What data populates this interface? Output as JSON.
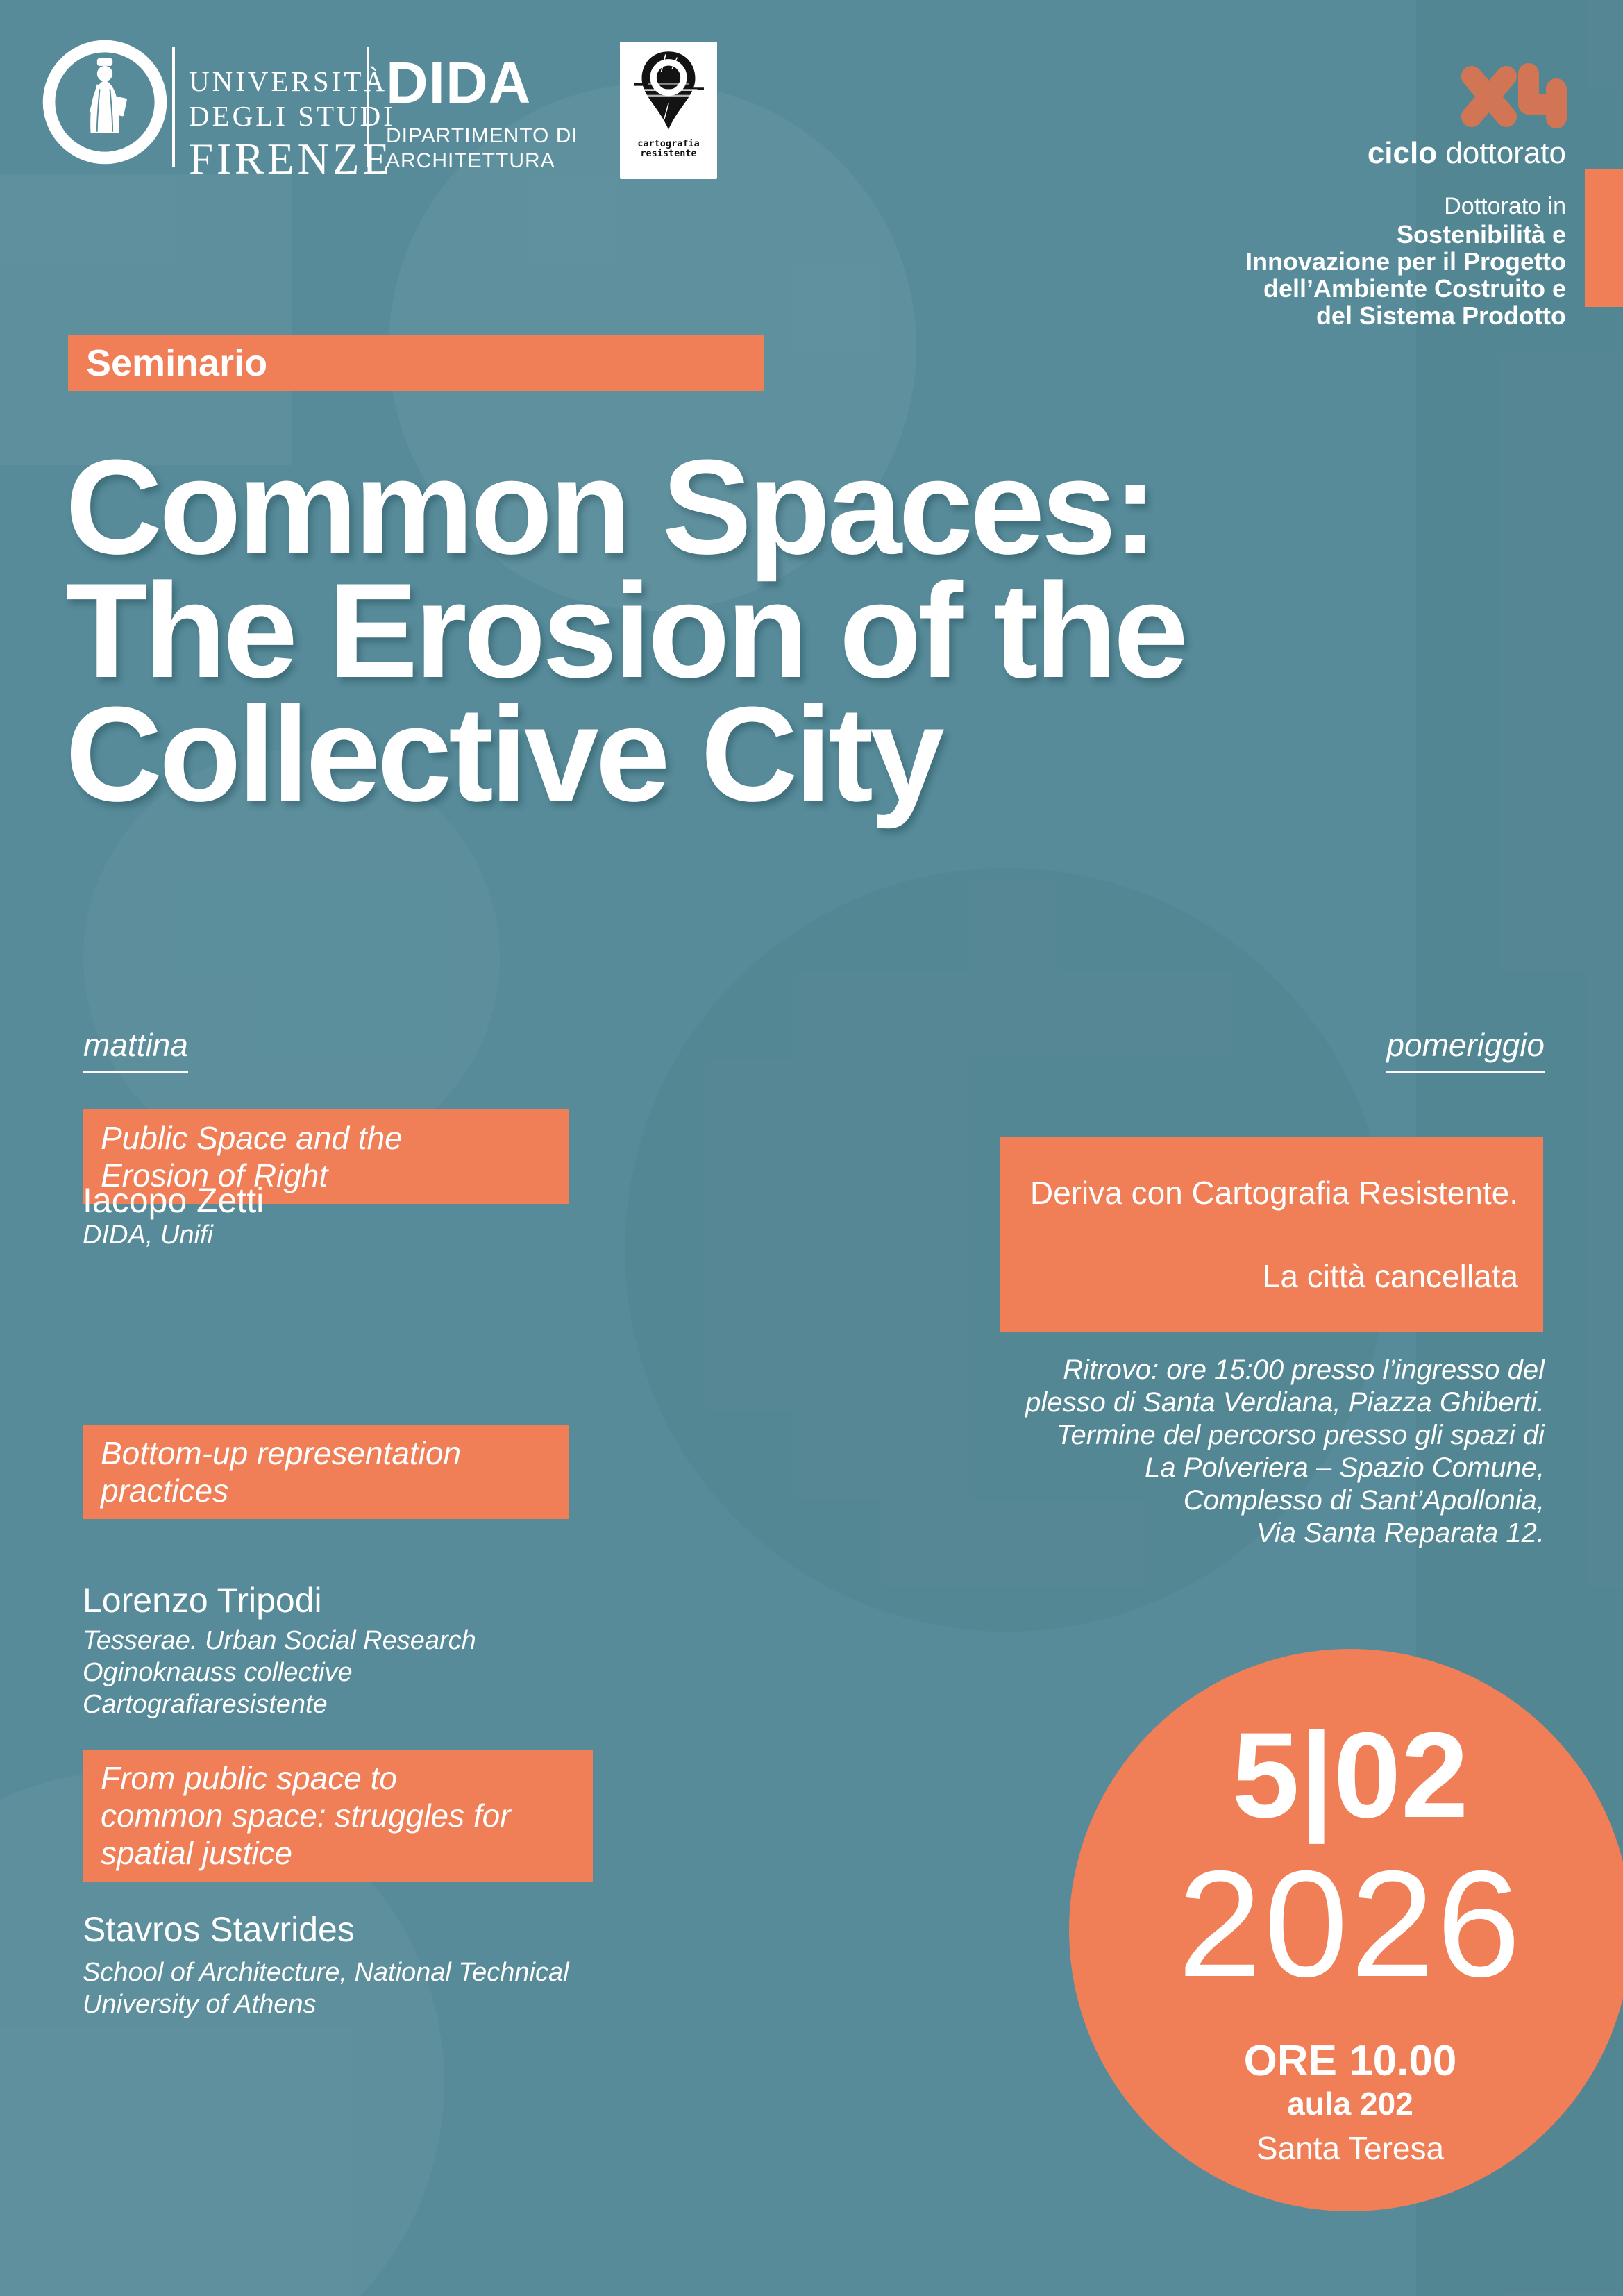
{
  "header": {
    "seal_text": "FLORENTINA · STUDIORUM · UNIVERSITAS ·",
    "university_lines": [
      "UNIVERSITÀ",
      "DEGLI STUDI",
      "FIRENZE"
    ],
    "dida": {
      "name": "DIDA",
      "dept_line1": "DIPARTIMENTO DI",
      "dept_line2": "ARCHITETTURA"
    },
    "cartografia_logo": {
      "line1": "cartografia",
      "line2": "resistente"
    }
  },
  "phd": {
    "cycle_roman": "XLI",
    "cycle_bold": "ciclo",
    "cycle_rest": " dottorato",
    "intro": "Dottorato in",
    "lines": [
      "Sostenibilità e",
      "Innovazione per il Progetto",
      "dell’Ambiente Costruito e",
      "del Sistema Prodotto"
    ]
  },
  "badge": "Seminario",
  "title_lines": [
    "Common Spaces:",
    "The Erosion of the",
    "Collective City"
  ],
  "sections": {
    "morning": "mattina",
    "afternoon": "pomeriggio"
  },
  "morning_sessions": [
    {
      "title_lines": [
        "Public Space and the",
        "Erosion of Right"
      ],
      "speaker": "Iacopo Zetti",
      "affiliation_lines": [
        "DIDA, Unifi"
      ]
    },
    {
      "title_lines": [
        "Bottom-up representation",
        "practices"
      ],
      "speaker": "Lorenzo Tripodi",
      "affiliation_lines": [
        "Tesserae. Urban Social Research",
        "Oginoknauss collective",
        "Cartografiaresistente"
      ]
    },
    {
      "title_lines": [
        "From public space to",
        "common space: struggles for",
        "spatial justice"
      ],
      "speaker": "Stavros Stavrides",
      "affiliation_lines": [
        "School of Architecture, National Technical",
        "University of Athens"
      ]
    }
  ],
  "afternoon": {
    "box_lines": [
      "Deriva con Cartografia Resistente.",
      "La città cancellata"
    ],
    "details_lines": [
      "Ritrovo: ore 15:00 presso l’ingresso del",
      "plesso di Santa Verdiana, Piazza Ghiberti.",
      "Termine del percorso presso gli spazi di",
      "La Polveriera – Spazio Comune,",
      "Complesso di Sant’Apollonia,",
      "Via Santa Reparata 12."
    ]
  },
  "event": {
    "day_month": "5|02",
    "year": "2026",
    "time": "ORE 10.00",
    "room": "aula 202",
    "venue": "Santa Teresa"
  },
  "colors": {
    "background": "#578B99",
    "accent": "#F07E56",
    "text": "#FFFFFF"
  }
}
